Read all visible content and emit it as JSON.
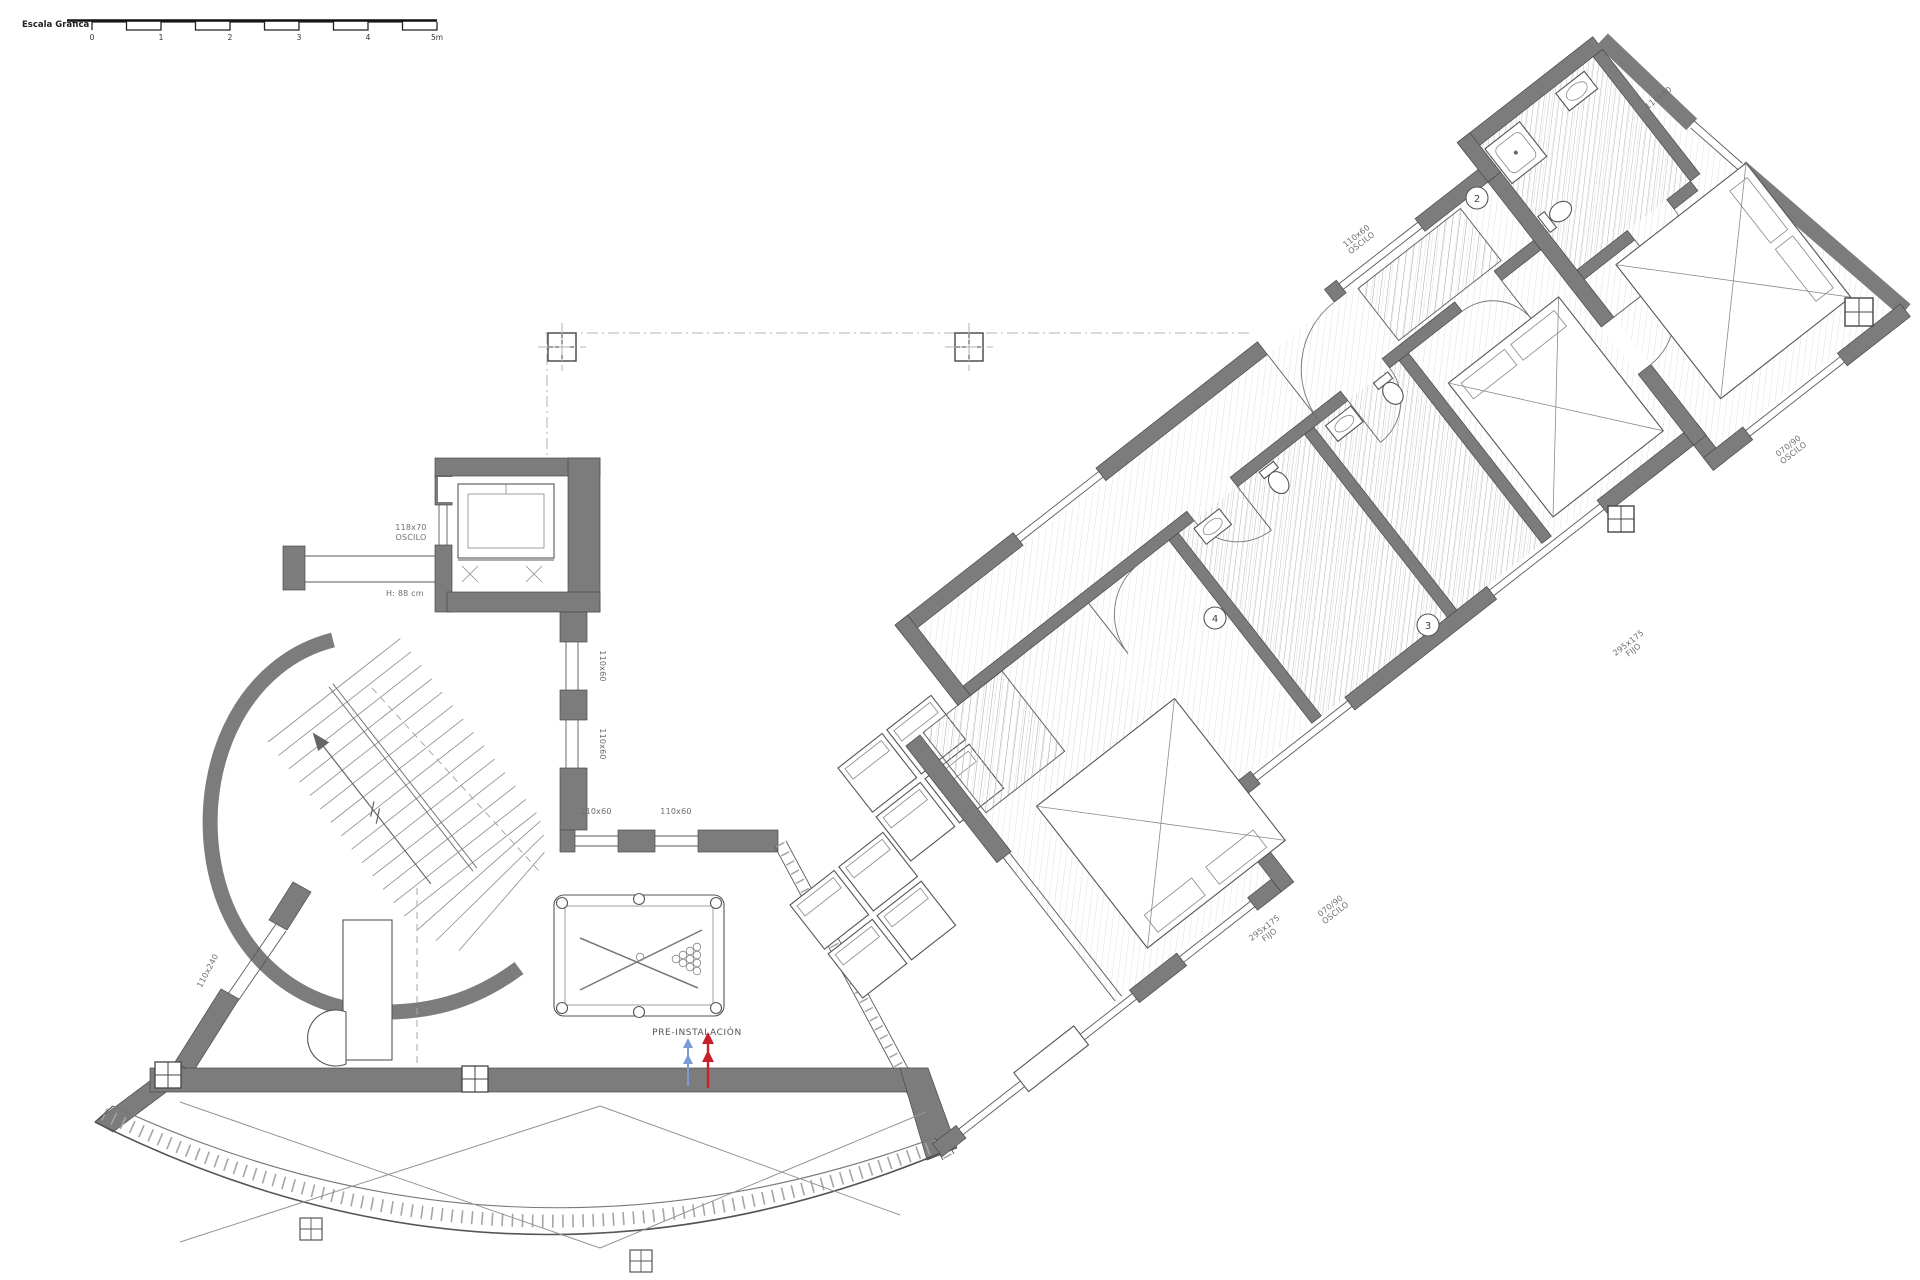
{
  "scale_bar": {
    "title": "Escala Gráfica",
    "ticks": {
      "t0": "0",
      "t1": "1",
      "t2": "2",
      "t3": "3",
      "t4": "4",
      "t5": "5m"
    }
  },
  "elevator": {
    "window_line1": "118x70",
    "window_line2": "OSCILO",
    "height_label": "H: 88 cm"
  },
  "room_numbers": {
    "bath_top": "2",
    "bath_right": "3",
    "bath_left": "4"
  },
  "window_labels": {
    "top_right": "110x60",
    "upper_wall_line1": "110x60",
    "upper_wall_line2": "OSCILO",
    "right_1_line1": "070/90",
    "right_1_line2": "OSCILO",
    "right_2_line1": "295x175",
    "right_2_line2": "FIJO",
    "lower_right_1_line1": "070/90",
    "lower_right_1_line2": "OSCILO",
    "lower_right_2_line1": "295x175",
    "lower_right_2_line2": "FIJO",
    "left_wall_upper": "110x60",
    "left_wall_lower": "110x60",
    "bottom_wall_1": "110x60",
    "bottom_wall_2": "110x60",
    "left_diagonal": "110x240"
  },
  "annotations": {
    "pre_installation": "PRE-INSTALACIÓN"
  }
}
